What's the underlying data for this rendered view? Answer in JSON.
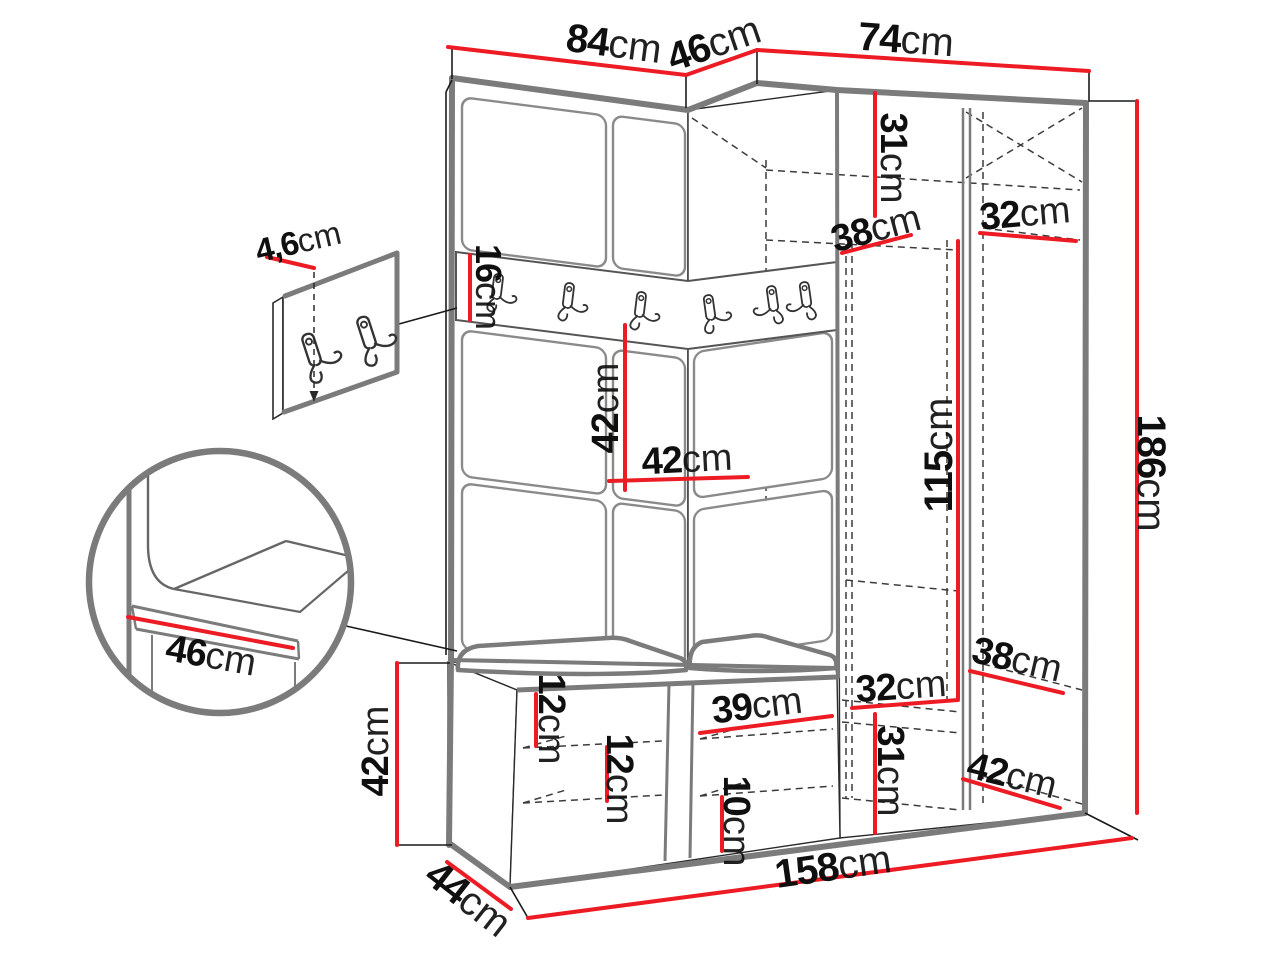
{
  "diagram": {
    "kind": "furniture dimension drawing",
    "subject": "corner hallway wardrobe with coat-hook rail, open shelves and shoe bench, plus two close-up details",
    "unit_suffix": "cm",
    "colors": {
      "dimension_red": "#ed1c24",
      "outline_gray": "#7b7b7b",
      "sketch_black": "#1a1a1a"
    },
    "hook_rail_hook_count": 6,
    "detail_panel_hook_count": 2,
    "labels": [
      {
        "id": "top-width-left",
        "value": "84",
        "unit": "cm"
      },
      {
        "id": "top-width-corner",
        "value": "46",
        "unit": "cm"
      },
      {
        "id": "top-width-right",
        "value": "74",
        "unit": "cm"
      },
      {
        "id": "total-height",
        "value": "186",
        "unit": "cm"
      },
      {
        "id": "top-shelf-height",
        "value": "31",
        "unit": "cm"
      },
      {
        "id": "top-shelf-depth",
        "value": "38",
        "unit": "cm"
      },
      {
        "id": "top-shelf-width",
        "value": "32",
        "unit": "cm"
      },
      {
        "id": "hook-rail-height",
        "value": "16",
        "unit": "cm"
      },
      {
        "id": "panel-height",
        "value": "42",
        "unit": "cm"
      },
      {
        "id": "panel-width",
        "value": "42",
        "unit": "cm"
      },
      {
        "id": "hanging-space-height",
        "value": "115",
        "unit": "cm"
      },
      {
        "id": "panel-thickness",
        "value": "4,6",
        "unit": "cm"
      },
      {
        "id": "seat-depth-detail",
        "value": "46",
        "unit": "cm"
      },
      {
        "id": "bench-height",
        "value": "42",
        "unit": "cm"
      },
      {
        "id": "bench-shelf-gap-a",
        "value": "12",
        "unit": "cm"
      },
      {
        "id": "bench-shelf-gap-b",
        "value": "12",
        "unit": "cm"
      },
      {
        "id": "bench-compartment-width",
        "value": "39",
        "unit": "cm"
      },
      {
        "id": "bench-bottom-gap",
        "value": "10",
        "unit": "cm"
      },
      {
        "id": "lower-shelf-width",
        "value": "32",
        "unit": "cm"
      },
      {
        "id": "lower-shelf-depth",
        "value": "38",
        "unit": "cm"
      },
      {
        "id": "lower-shelf-height",
        "value": "31",
        "unit": "cm"
      },
      {
        "id": "lower-right-depth",
        "value": "42",
        "unit": "cm"
      },
      {
        "id": "total-width",
        "value": "158",
        "unit": "cm"
      },
      {
        "id": "bench-side-depth",
        "value": "44",
        "unit": "cm"
      }
    ]
  }
}
